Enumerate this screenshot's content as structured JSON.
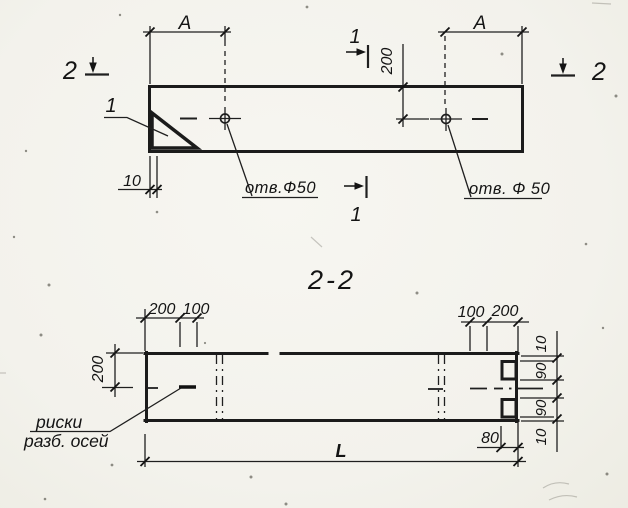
{
  "palette": {
    "paper": "#f3f2ec",
    "ink": "#1b1b1b"
  },
  "plan_view": {
    "section2_left_label": "2",
    "section2_right_label": "2",
    "section1_top_label": "1",
    "section1_bottom_label": "1",
    "dim_A_left": "A",
    "dim_A_right": "A",
    "dim_200_vertical": "200",
    "dim_10_end_offset": "10",
    "corner_plate_ref": "1",
    "hole_label_left": "отв.Ф50",
    "hole_label_right": "отв. Ф 50"
  },
  "section_view": {
    "title": "2-2",
    "dim_200_top_left": "200",
    "dim_100_top_left": "100",
    "dim_100_top_right": "100",
    "dim_200_top_right": "200",
    "dim_200_left_vertical": "200",
    "right_chain_top_10": "10",
    "right_chain_90_upper": "90",
    "right_chain_90_lower": "90",
    "right_chain_bottom_10": "10",
    "dim_80_end": "80",
    "dim_length": "L",
    "axes_note_line1": "риски",
    "axes_note_line2": "разб. осей"
  }
}
